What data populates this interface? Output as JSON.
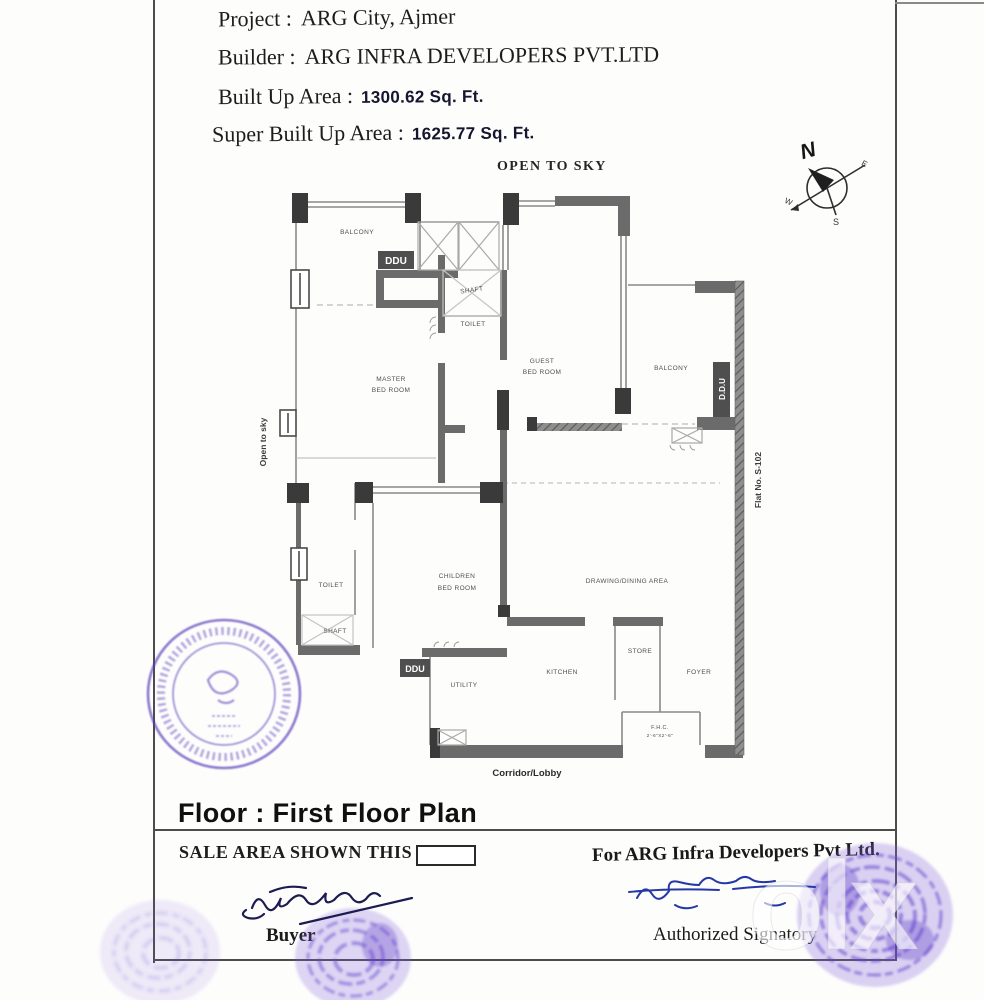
{
  "header": {
    "project_label": "Project :",
    "project_value": "ARG City, Ajmer",
    "builder_label": "Builder :",
    "builder_value": "ARG INFRA DEVELOPERS PVT.LTD",
    "built_up_label": "Built Up Area :",
    "built_up_value": "1300.62 Sq. Ft.",
    "super_built_up_label": "Super Built Up Area :",
    "super_built_up_value": "1625.77 Sq. Ft."
  },
  "compass": {
    "n": "N",
    "e": "E",
    "s": "S",
    "w": "W"
  },
  "plan": {
    "open_to_sky_top": "OPEN TO SKY",
    "open_to_sky_left": "Open to sky",
    "flat_no": "Flat No. S-102",
    "balcony_top_left": "BALCONY",
    "balcony_right": "BALCONY",
    "shaft_upper": "SHAFT",
    "toilet_upper": "TOILET",
    "master_line1": "MASTER",
    "master_line2": "BED ROOM",
    "guest_line1": "GUEST",
    "guest_line2": "BED ROOM",
    "children_line1": "CHILDREN",
    "children_line2": "BED ROOM",
    "toilet_lower": "TOILET",
    "shaft_lower": "SHAFT",
    "drawing_dining": "DRAWING/DINING AREA",
    "kitchen": "KITCHEN",
    "store": "STORE",
    "foyer": "FOYER",
    "utility": "UTILITY",
    "fhc_line1": "F.H.C.",
    "fhc_line2": "2'-6\"X2'-6\"",
    "corridor": "Corridor/Lobby",
    "ddu_top": "DDU",
    "ddu_right": "D.D.U",
    "ddu_bottom": "DDU"
  },
  "footer": {
    "floor_title": "Floor : First Floor Plan",
    "sale_area_label": "SALE AREA SHOWN THIS",
    "for_company": "For ARG Infra Developers Pvt Ltd.",
    "buyer_label": "Buyer",
    "authorized_label": "Authorized Signatory"
  },
  "watermark": "olx"
}
